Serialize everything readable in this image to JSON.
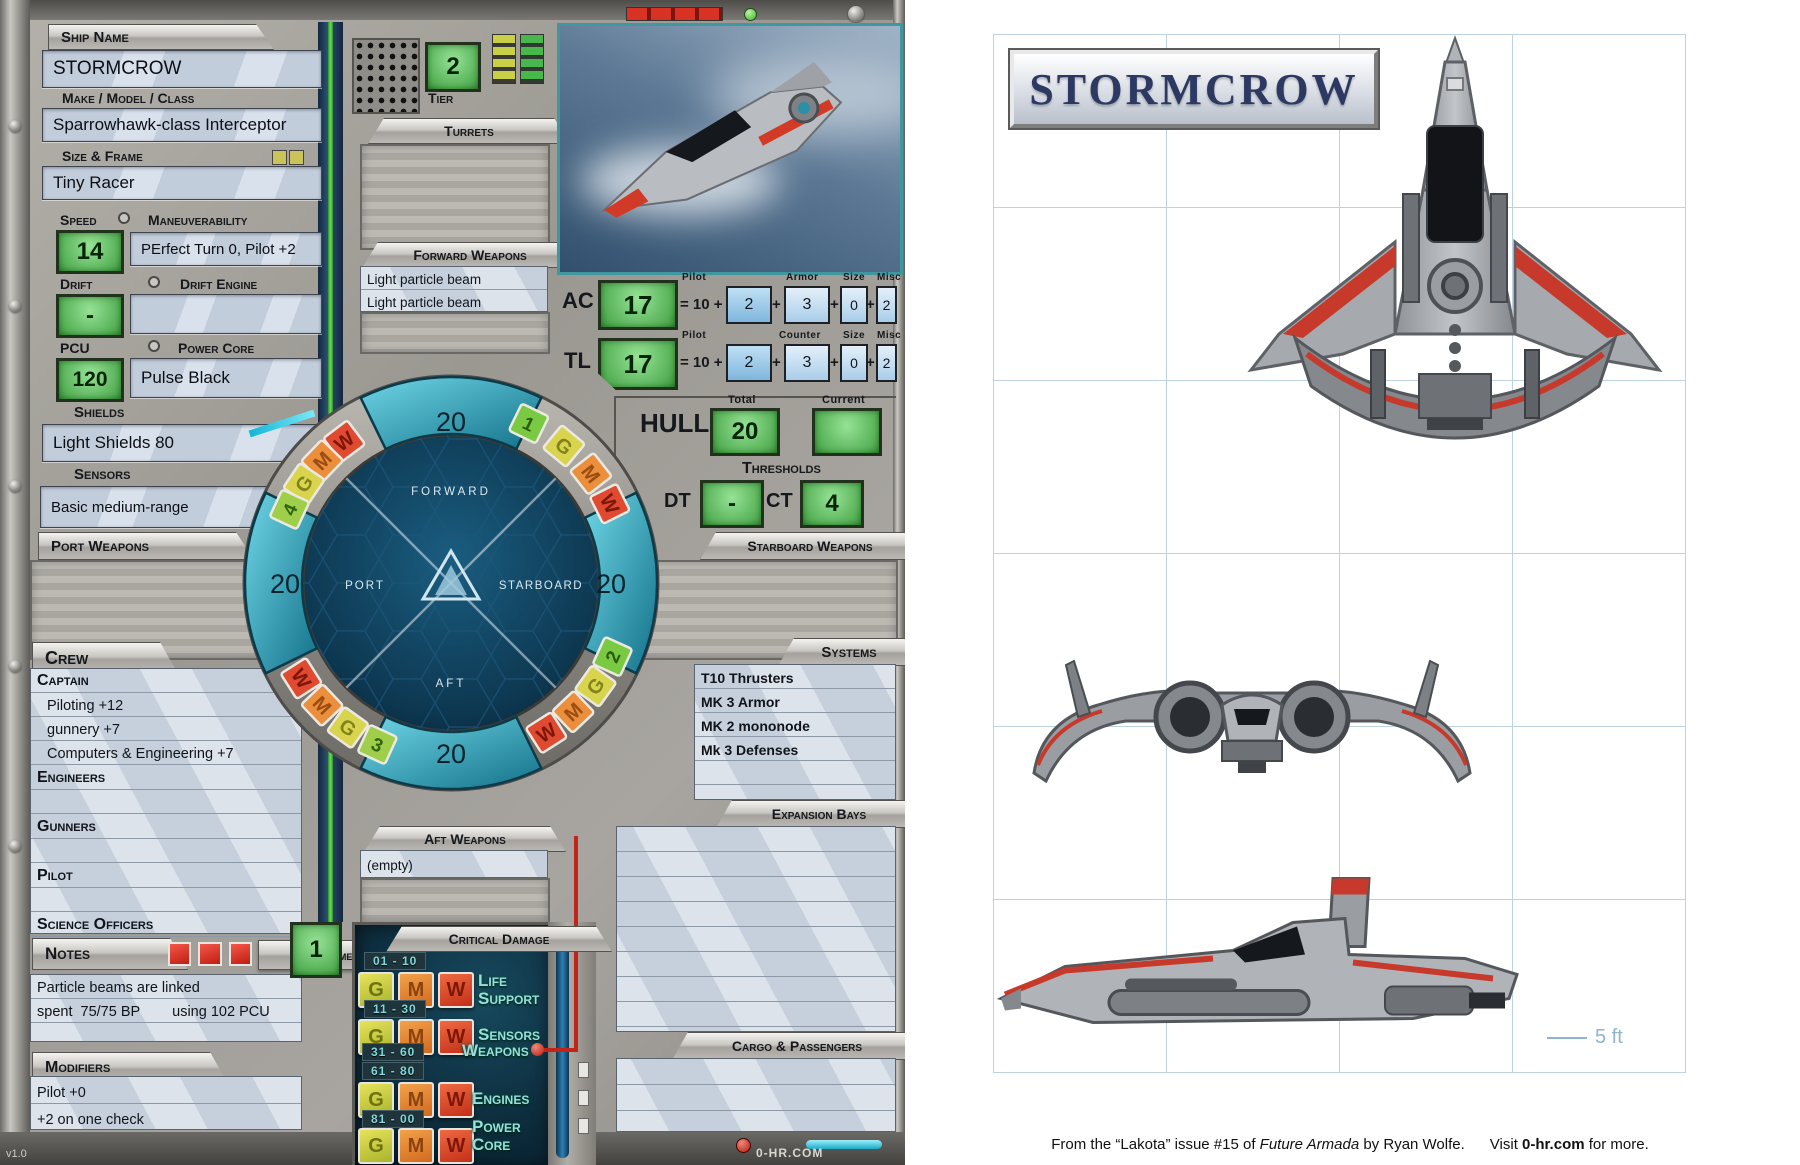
{
  "sheet": {
    "version": "v1.0",
    "site": "0-HR.COM",
    "ship_name_label": "Ship Name",
    "ship_name": "STORMCROW",
    "make_label": "Make / Model / Class",
    "make": "Sparrowhawk-class Interceptor",
    "frame_label": "Size & Frame",
    "frame": "Tiny Racer",
    "speed_label": "Speed",
    "speed": "14",
    "maneuver_label": "Maneuverability",
    "maneuver": "PErfect Turn 0, Pilot +2",
    "drift_label": "Drift",
    "drift": "-",
    "drift_engine_label": "Drift Engine",
    "drift_engine": "",
    "pcu_label": "PCU",
    "pcu": "120",
    "power_core_label": "Power Core",
    "power_core": "Pulse Black",
    "shields_label": "Shields",
    "shields": "Light Shields 80",
    "sensors_label": "Sensors",
    "sensors": "Basic medium-range",
    "tier_label": "Tier",
    "tier": "2",
    "turrets_label": "Turrets",
    "forward_weapons_label": "Forward Weapons",
    "forward_weapons": [
      "Light particle beam",
      "Light particle beam"
    ],
    "port_weapons_label": "Port Weapons",
    "starboard_weapons_label": "Starboard Weapons",
    "aft_weapons_label": "Aft Weapons",
    "aft_weapons": [
      "(empty)"
    ],
    "ac": {
      "label": "AC",
      "value": "17",
      "formula": "= 10 +",
      "c1_label": "Pilot",
      "c1": "2",
      "c2_label": "Armor",
      "c2": "3",
      "c3_label": "Size",
      "c3": "0",
      "c4_label": "Misc",
      "c4": "2"
    },
    "tl": {
      "label": "TL",
      "value": "17",
      "formula": "= 10 +",
      "c1_label": "Pilot",
      "c1": "2",
      "c2_label": "Counter",
      "c2": "3",
      "c3_label": "Size",
      "c3": "0",
      "c4_label": "Misc",
      "c4": "2"
    },
    "hull_label": "HULL",
    "hull_total_label": "Total",
    "hull_total": "20",
    "hull_current_label": "Current",
    "hull_current": "",
    "thresholds_label": "Thresholds",
    "dt_label": "DT",
    "dt": "-",
    "ct_label": "CT",
    "ct": "4",
    "diagram": {
      "forward": "FORWARD",
      "port": "PORT",
      "starboard": "STARBOARD",
      "aft": "AFT",
      "shield_forward": "20",
      "shield_port": "20",
      "shield_starboard": "20",
      "shield_aft": "20",
      "chips_ul": [
        "W",
        "M",
        "G",
        "4"
      ],
      "chips_ur": [
        "1",
        "G",
        "M",
        "W"
      ],
      "chips_ll": [
        "W",
        "M",
        "G",
        "3"
      ],
      "chips_lr": [
        "W",
        "M",
        "G",
        "2"
      ]
    },
    "crew_label": "Crew",
    "crew": {
      "captain_label": "Captain",
      "captain_skills": [
        "Piloting +12",
        "gunnery   +7",
        "Computers & Engineering +7"
      ],
      "engineers_label": "Engineers",
      "gunners_label": "Gunners",
      "pilot_label": "Pilot",
      "science_label": "Science Officers"
    },
    "notes_label": "Notes",
    "complement_label": "Complement",
    "complement": "1",
    "notes_lines": [
      "Particle beams are linked",
      "spent  75/75 BP        using 102 PCU"
    ],
    "modifiers_label": "Modifiers",
    "modifier_lines": [
      "Pilot +0",
      "+2 on one check"
    ],
    "systems_label": "Systems",
    "systems": [
      "T10 Thrusters",
      "MK 3 Armor",
      "MK 2 mononode",
      "Mk 3 Defenses"
    ],
    "expansion_label": "Expansion Bays",
    "cargo_label": "Cargo & Passengers",
    "critical_label": "Critical Damage",
    "critical_rows": [
      {
        "range": "01 - 10",
        "system": "Life Support"
      },
      {
        "range": "11 - 30",
        "system": "Sensors"
      },
      {
        "range": "31 - 60",
        "system": "Weapons"
      },
      {
        "range": "61 - 80",
        "system": "Engines"
      },
      {
        "range": "81 - 00",
        "system": "Power Core"
      }
    ],
    "gmw": [
      "G",
      "M",
      "W"
    ]
  },
  "page": {
    "title": "STORMCROW",
    "scale": "5 ft",
    "footer_1": "From the “Lakota” issue #15 of ",
    "footer_2": "Future Armada",
    "footer_3": " by ",
    "footer_4": "Ryan Wolfe.",
    "footer_5": "      Visit ",
    "footer_6": "0-hr.com",
    "footer_7": " for more."
  },
  "colors": {
    "accent_green": "#6cc26c",
    "accent_teal": "#2e8fa6",
    "accent_red": "#d23a28",
    "grid_blue": "#bdd3e4",
    "title_navy": "#2c3a63"
  }
}
